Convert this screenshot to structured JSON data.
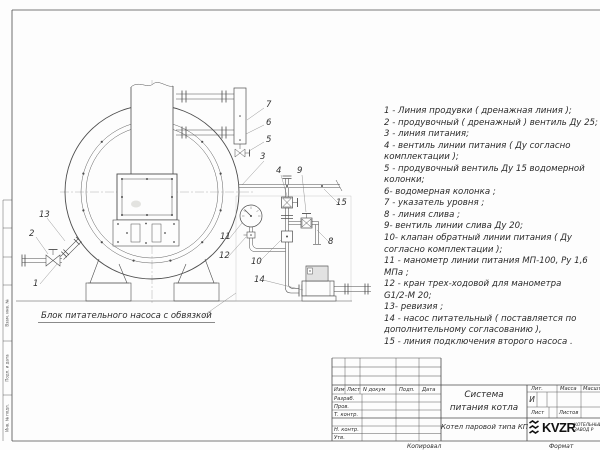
{
  "sheet": {
    "background": "#fdfdfd",
    "line_color": "#4d4d4d"
  },
  "legend": {
    "items": [
      "1 - Линия продувки ( дренажная линия );",
      "2 - продувочный ( дренажный ) вентиль Ду 25;",
      "3 - линия питания;",
      "4 - вентиль линии питания ( Ду согласно\nкомплектации );",
      "5 - продувочный вентиль Ду 15 водомерной\nколонки;",
      "6- водомерная колонка ;",
      "7 - указатель уровня ;",
      "8 - линия слива ;",
      "9- вентиль линии слива Ду 20;",
      "10- клапан обратный линии питания ( Ду\nсогласно комплектации );",
      "11 - манометр линии питания МП-100, Ру 1,6\nМПа ;",
      "12 - кран трех-ходовой для манометра\nG1/2-М 20;",
      "13- ревизия ;",
      "14 - насос питательный ( поставляется по\nдополнительному согласованию ),",
      "15 - линия подключения второго насоса ."
    ]
  },
  "drawing": {
    "caption": "Блок питательного насоса с обвязкой",
    "part_labels": [
      "1",
      "2",
      "3",
      "4",
      "5",
      "6",
      "7",
      "8",
      "9",
      "10",
      "11",
      "12",
      "13",
      "14",
      "15"
    ]
  },
  "title_block": {
    "header_cols": [
      "Изм",
      "Лист",
      "N докум",
      "Подп.",
      "Дата"
    ],
    "sig_rows": [
      "Разраб.",
      "Пров.",
      "Т. контр.",
      "Н. контр.",
      "Утв."
    ],
    "title": "Система\nпитания котла",
    "product": "Котел паровой типа КП",
    "lit_label": "Лит.",
    "mass_label": "Масса",
    "scale_label": "Масштаб",
    "lit_value": "И",
    "sheet_label": "Лист",
    "sheets_label": "Листов",
    "logo": {
      "text": "KVZR",
      "sub1": "КОТЕЛЬНЫЙ",
      "sub2": "ЗАВОД Р"
    },
    "copied": "Копировал",
    "format": "Формат"
  },
  "margin_labels": [
    "Взам. инв. №",
    "Подп. и дата",
    "Инв. № подл."
  ]
}
